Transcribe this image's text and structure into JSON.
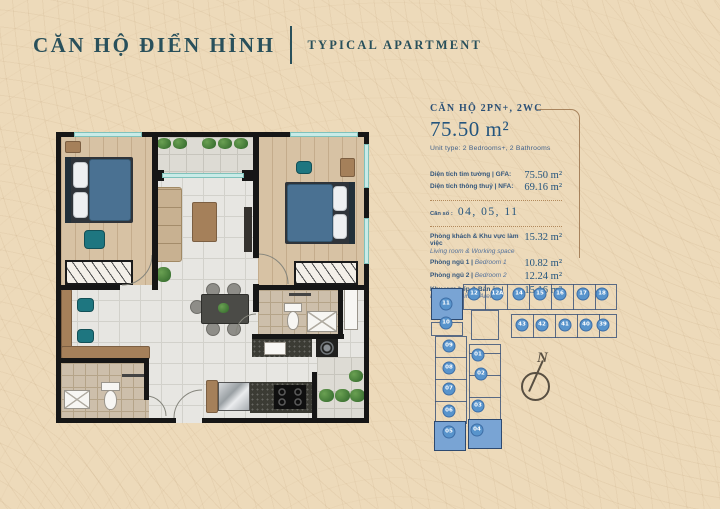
{
  "header": {
    "title_vi": "CĂN HỘ ĐIỂN HÌNH",
    "title_en": "TYPICAL APARTMENT"
  },
  "info": {
    "unit_type_vi": "CĂN HỘ 2PN+, 2WC",
    "area_total": "75.50 m²",
    "unit_type_en": "Unit type: 2 Bedrooms+, 2 Bathrooms",
    "gfa_label": "Diện tích tim tường | GFA:",
    "gfa_value": "75.50 m²",
    "nfa_label": "Diện tích thông thuỷ | NFA:",
    "nfa_value": "69.16 m²",
    "unit_no_label": "Căn số :",
    "unit_no_value": "04, 05, 11",
    "rooms": [
      {
        "label_vi": "Phòng khách & Khu vực làm việc",
        "label_en": "Living room & Working space",
        "stacked": true,
        "area": "15.32 m²"
      },
      {
        "label_vi": "Phòng ngủ 1",
        "label_en": "Bedroom 1",
        "area": "10.82 m²"
      },
      {
        "label_vi": "Phòng ngủ 2",
        "label_en": "Bedroom 2",
        "area": "12.24 m²"
      },
      {
        "label_vi": "Khu vực bếp & Bàn ăn",
        "label_en": "Kitchen & Dining Area",
        "area": "15.16 m²"
      }
    ]
  },
  "keyplan": {
    "highlighted_units": "04, 05, 11",
    "units": [
      {
        "id": "12",
        "x": 49,
        "y": 22
      },
      {
        "id": "12A",
        "x": 72,
        "y": 22
      },
      {
        "id": "14",
        "x": 94,
        "y": 22
      },
      {
        "id": "15",
        "x": 115,
        "y": 22
      },
      {
        "id": "16",
        "x": 135,
        "y": 22
      },
      {
        "id": "17",
        "x": 158,
        "y": 22
      },
      {
        "id": "18",
        "x": 177,
        "y": 22
      },
      {
        "id": "11",
        "x": 21,
        "y": 32,
        "hl": true
      },
      {
        "id": "10",
        "x": 21,
        "y": 51
      },
      {
        "id": "43",
        "x": 97,
        "y": 53
      },
      {
        "id": "42",
        "x": 117,
        "y": 53
      },
      {
        "id": "41",
        "x": 140,
        "y": 53
      },
      {
        "id": "40",
        "x": 161,
        "y": 53
      },
      {
        "id": "39",
        "x": 178,
        "y": 53
      },
      {
        "id": "09",
        "x": 24,
        "y": 74
      },
      {
        "id": "01",
        "x": 53,
        "y": 83
      },
      {
        "id": "08",
        "x": 24,
        "y": 96
      },
      {
        "id": "02",
        "x": 56,
        "y": 102
      },
      {
        "id": "07",
        "x": 24,
        "y": 117
      },
      {
        "id": "06",
        "x": 24,
        "y": 139
      },
      {
        "id": "03",
        "x": 53,
        "y": 134
      },
      {
        "id": "05",
        "x": 24,
        "y": 160,
        "hl": true
      },
      {
        "id": "04",
        "x": 52,
        "y": 158,
        "hl": true
      }
    ]
  },
  "compass": {
    "label": "N"
  }
}
